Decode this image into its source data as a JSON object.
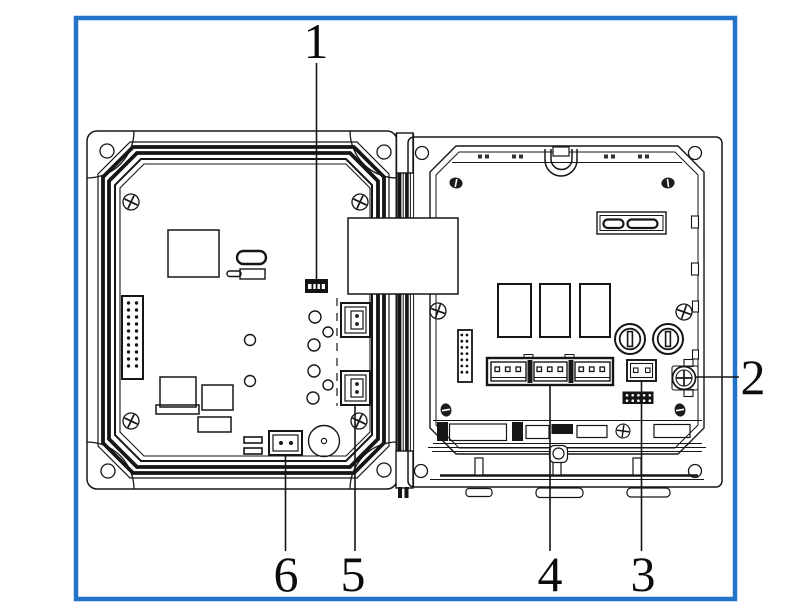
{
  "colors": {
    "frame_border": "#2374c8",
    "line_art": "#161616",
    "background": "#ffffff"
  },
  "callouts": [
    {
      "text": "1"
    },
    {
      "text": "2"
    },
    {
      "text": "3"
    },
    {
      "text": "4"
    },
    {
      "text": "5"
    },
    {
      "text": "6"
    }
  ]
}
